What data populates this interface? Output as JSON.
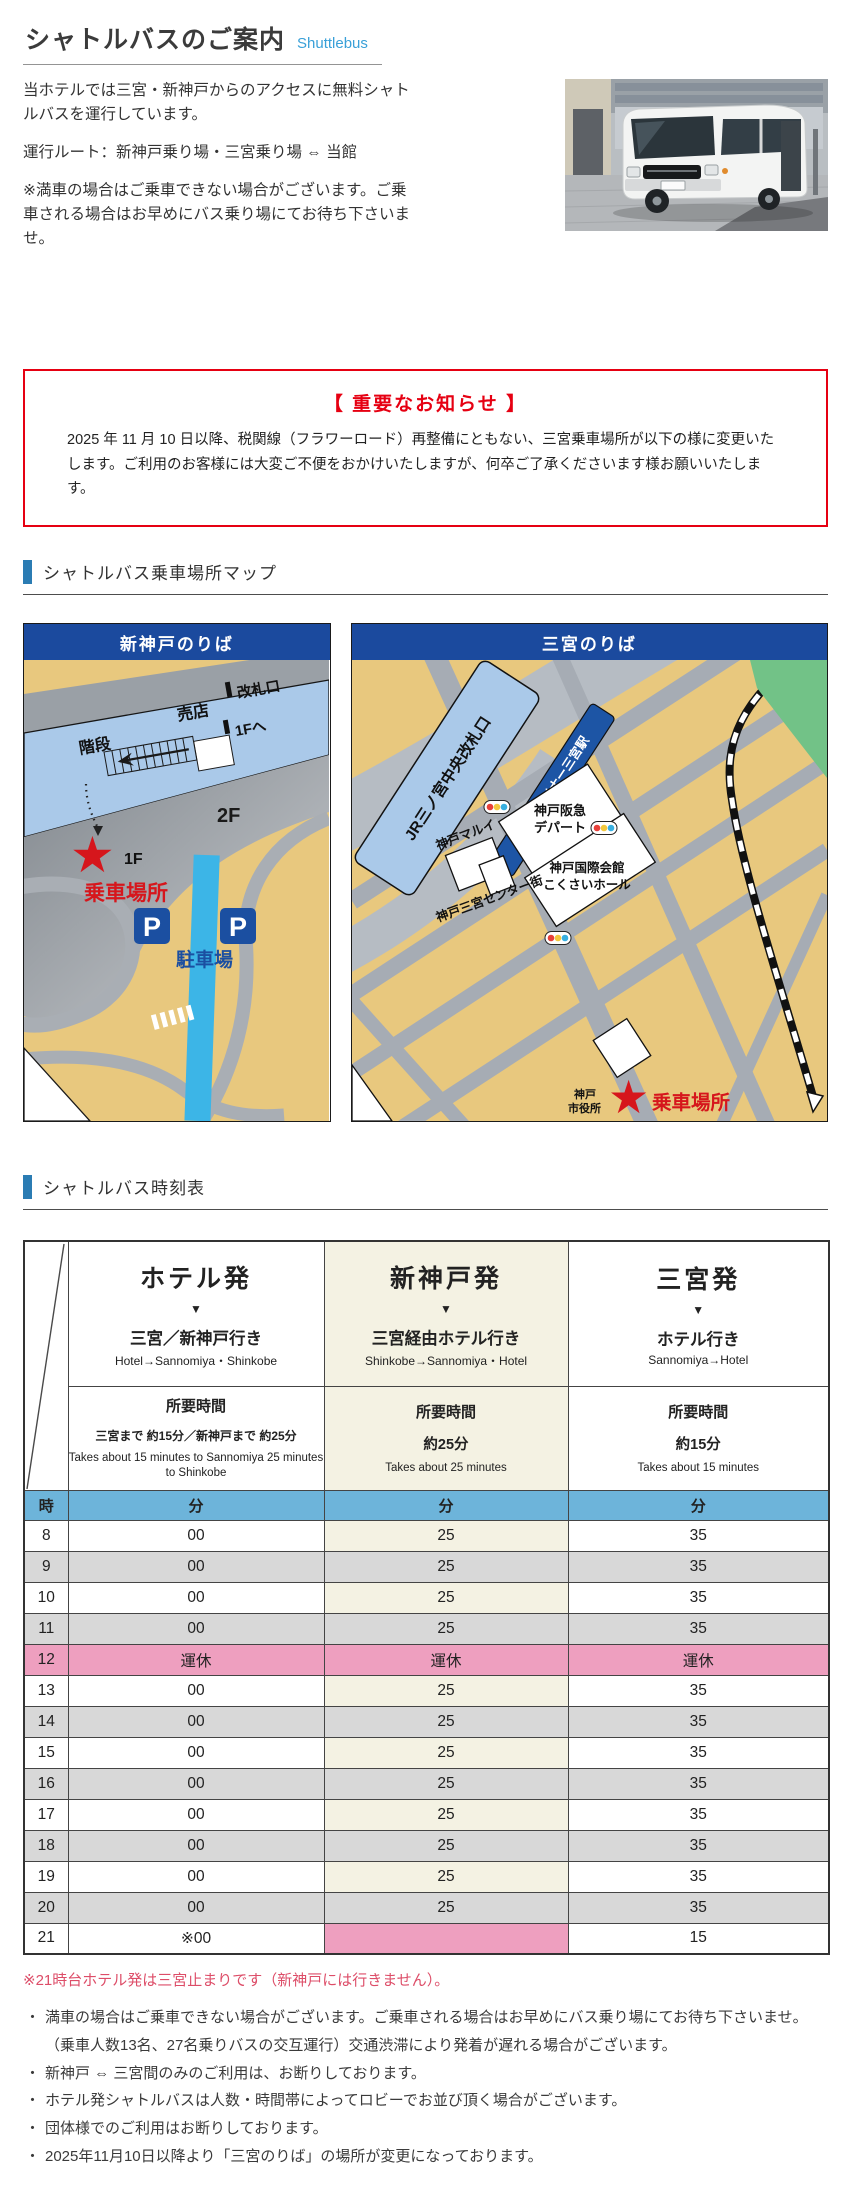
{
  "page": {
    "title": "シャトルバスのご案内",
    "title_en": "Shuttlebus"
  },
  "intro": {
    "p1": "当ホテルでは三宮・新神戸からのアクセスに無料シャトルバスを運行しています。",
    "route": "運行ルート：新神戸乗り場・三宮乗り場 ⇔ 当館",
    "note": "※満車の場合はご乗車できない場合がございます。ご乗車される場合はお早めにバス乗り場にてお待ち下さいませ。"
  },
  "notice": {
    "title": "【 重要なお知らせ 】",
    "body": "2025 年 11 月 10 日以降、税関線（フラワーロード）再整備にともない、三宮乗車場所が以下の様に変更いたします。ご利用のお客様には大変ご不便をおかけいたしますが、何卒ご了承くださいます様お願いいたします。"
  },
  "sections": {
    "map": "シャトルバス乗車場所マップ",
    "timetable": "シャトルバス時刻表"
  },
  "maps": {
    "shinkobe": {
      "title": "新神戸のりば",
      "labels": {
        "shop": "売店",
        "gate": "改札口",
        "stairs": "階段",
        "to_1f": "1Fへ",
        "floor2": "2F",
        "floor1": "1F",
        "boarding": "乗車場所",
        "parking": "駐車場",
        "p": "P",
        "star": "★"
      }
    },
    "sannomiya": {
      "title": "三宮のりば",
      "labels": {
        "jr": "JR三ノ宮中央改札口",
        "portliner": "ポートライナー三宮駅",
        "hankyu1": "神戸阪急",
        "hankyu2": "デパート",
        "marui": "神戸マルイ",
        "kokusai1": "神戸国際会館",
        "kokusai2": "こくさいホール",
        "center_gai": "神戸三宮センター街",
        "cityhall1": "神戸",
        "cityhall2": "市役所",
        "boarding": "乗車場所",
        "star": "★"
      }
    }
  },
  "timetable": {
    "hour_header": "時",
    "min_header": "分",
    "columns": [
      {
        "from": "ホテル発",
        "arrow": "▼",
        "to": "三宮／新神戸行き",
        "to_en": "Hotel→Sannomiya・Shinkobe",
        "duration_label": "所要時間",
        "duration": "三宮まで 約15分／新神戸まで 約25分",
        "duration_en": "Takes about 15 minutes to Sannomiya 25 minutes to Shinkobe"
      },
      {
        "from": "新神戸発",
        "arrow": "▼",
        "to": "三宮経由ホテル行き",
        "to_en": "Shinkobe→Sannomiya・Hotel",
        "duration_label": "所要時間",
        "duration": "約25分",
        "duration_en": "Takes about 25 minutes"
      },
      {
        "from": "三宮発",
        "arrow": "▼",
        "to": "ホテル行き",
        "to_en": "Sannomiya→Hotel",
        "duration_label": "所要時間",
        "duration": "約15分",
        "duration_en": "Takes about 15 minutes"
      }
    ],
    "rows": [
      {
        "hour": "8",
        "cells": [
          "00",
          "25",
          "35"
        ],
        "variant": "light"
      },
      {
        "hour": "9",
        "cells": [
          "00",
          "25",
          "35"
        ],
        "variant": "dark"
      },
      {
        "hour": "10",
        "cells": [
          "00",
          "25",
          "35"
        ],
        "variant": "light"
      },
      {
        "hour": "11",
        "cells": [
          "00",
          "25",
          "35"
        ],
        "variant": "dark"
      },
      {
        "hour": "12",
        "cells": [
          "運休",
          "運休",
          "運休"
        ],
        "variant": "closed"
      },
      {
        "hour": "13",
        "cells": [
          "00",
          "25",
          "35"
        ],
        "variant": "light"
      },
      {
        "hour": "14",
        "cells": [
          "00",
          "25",
          "35"
        ],
        "variant": "dark"
      },
      {
        "hour": "15",
        "cells": [
          "00",
          "25",
          "35"
        ],
        "variant": "light"
      },
      {
        "hour": "16",
        "cells": [
          "00",
          "25",
          "35"
        ],
        "variant": "dark"
      },
      {
        "hour": "17",
        "cells": [
          "00",
          "25",
          "35"
        ],
        "variant": "light"
      },
      {
        "hour": "18",
        "cells": [
          "00",
          "25",
          "35"
        ],
        "variant": "dark"
      },
      {
        "hour": "19",
        "cells": [
          "00",
          "25",
          "35"
        ],
        "variant": "light"
      },
      {
        "hour": "20",
        "cells": [
          "00",
          "25",
          "35"
        ],
        "variant": "dark"
      },
      {
        "hour": "21",
        "cells": [
          "※00",
          "",
          "15"
        ],
        "variant": "final"
      }
    ]
  },
  "footnote_red": "※21時台ホテル発は三宮止まりです（新神戸には行きません）。",
  "notes": [
    "満車の場合はご乗車できない場合がございます。ご乗車される場合はお早めにバス乗り場にてお待ち下さいませ。（乗車人数13名、27名乗りバスの交互運行）交通渋滞により発着が遅れる場合がございます。",
    "新神戸 ⇔ 三宮間のみのご利用は、お断りしております。",
    "ホテル発シャトルバスは人数・時間帯によってロビーでお並び頂く場合がございます。",
    "団体様でのご利用はお断りしております。",
    "2025年11月10日以降より「三宮のりば」の場所が変更になっております。"
  ],
  "colors": {
    "accent_blue": "#2b7cb3",
    "link_blue": "#39a0d8",
    "notice_red": "#e60012",
    "footnote_red": "#dd4d68",
    "map_header_blue": "#1b4a9e",
    "map_tan": "#e8c87e",
    "map_station_blue": "#aac9e9",
    "river_blue": "#3cb5e7",
    "park_green": "#72c287",
    "star_red": "#d6161c",
    "table_header_blue": "#6db4da",
    "row_gray": "#d8d8d8",
    "closed_pink": "#ee9fbf",
    "column_beige": "#f4f2e3"
  }
}
